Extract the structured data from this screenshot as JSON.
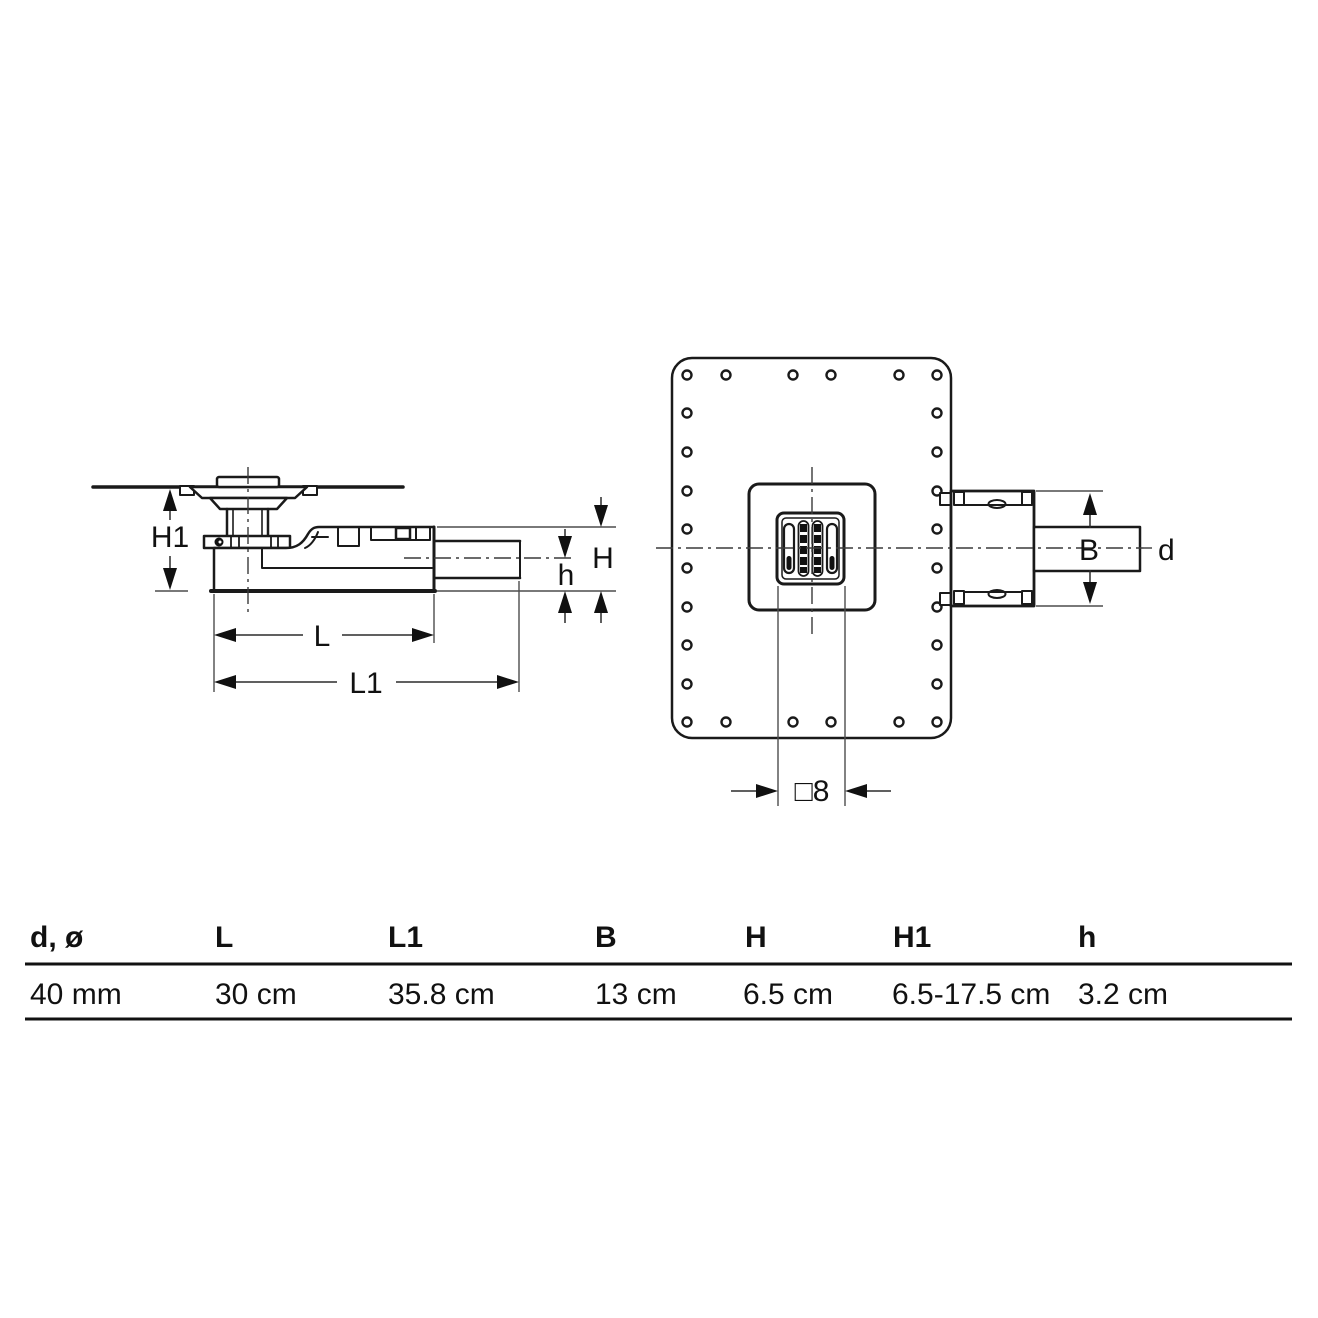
{
  "colors": {
    "background": "#ffffff",
    "line": "#1a1a1a"
  },
  "dimension_labels": {
    "H1": "H1",
    "H": "H",
    "h": "h",
    "L": "L",
    "L1": "L1",
    "B": "B",
    "d": "d",
    "grate_square": "□8"
  },
  "table": {
    "headers": [
      "d, ø",
      "L",
      "L1",
      "B",
      "H",
      "H1",
      "h"
    ],
    "values": [
      "40 mm",
      "30 cm",
      "35.8 cm",
      "13 cm",
      "6.5 cm",
      "6.5-17.5 cm",
      "3.2 cm"
    ]
  }
}
